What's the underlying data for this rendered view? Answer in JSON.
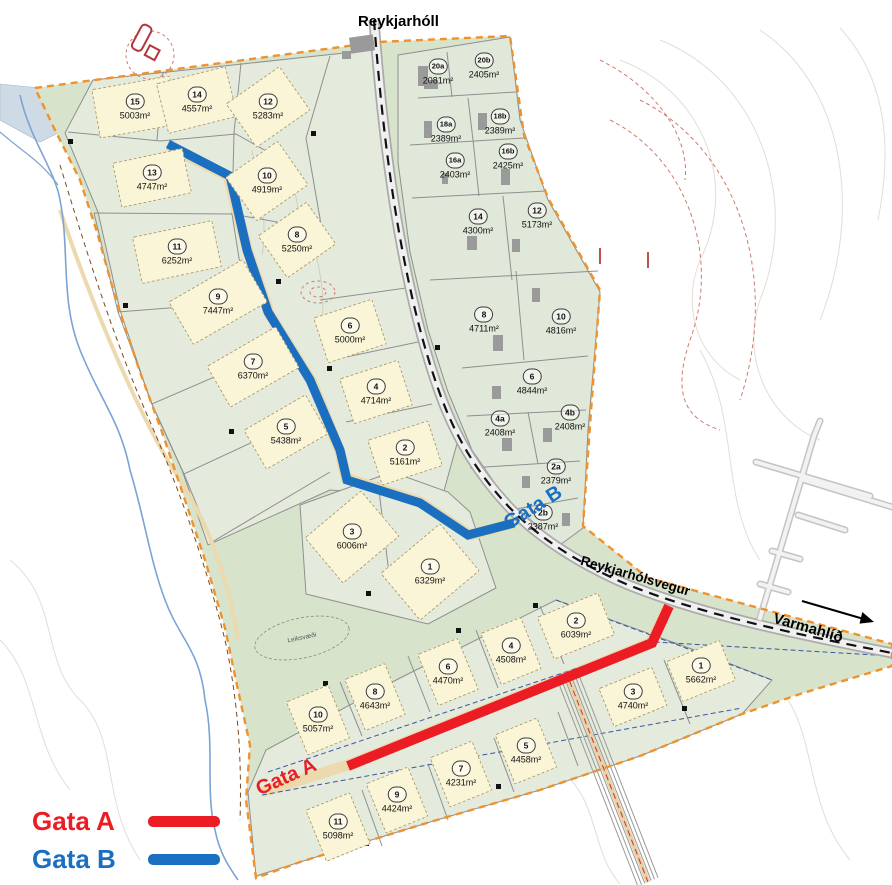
{
  "labels": {
    "reykjarholl": "Reykjarhóll",
    "reykjarholsvegur": "Reykjarhólsvegur",
    "varmahlid": "Varmahlíð",
    "gata_a_road": "Gata A",
    "gata_b_road": "Gata B",
    "leiksvaedi": "Leiksvæði"
  },
  "legend": {
    "items": [
      {
        "label": "Gata A",
        "color": "#ec1c24"
      },
      {
        "label": "Gata B",
        "color": "#1b6fc0"
      }
    ]
  },
  "colors": {
    "gata_a": "#ec1c24",
    "gata_b": "#1b6fc0",
    "boundary_orange": "#f0922c",
    "site_green": "#d8e3cc",
    "lot_green": "#e4ebdd",
    "envelope_yellow": "#fbf5d8"
  },
  "zones": [
    {
      "id": "northwest",
      "lots": [
        {
          "no": "15",
          "area": "5003m²",
          "x": 135,
          "y": 107,
          "env": {
            "w": 78,
            "h": 48,
            "rot": -10
          }
        },
        {
          "no": "14",
          "area": "4557m²",
          "x": 197,
          "y": 100,
          "env": {
            "w": 70,
            "h": 50,
            "rot": -14
          }
        },
        {
          "no": "12",
          "area": "5283m²",
          "x": 268,
          "y": 107,
          "env": {
            "w": 64,
            "h": 52,
            "rot": -35
          }
        },
        {
          "no": "13",
          "area": "4747m²",
          "x": 152,
          "y": 178,
          "env": {
            "w": 70,
            "h": 44,
            "rot": -12
          }
        },
        {
          "no": "10",
          "area": "4919m²",
          "x": 267,
          "y": 181,
          "env": {
            "w": 62,
            "h": 52,
            "rot": -35
          }
        },
        {
          "no": "8",
          "area": "5250m²",
          "x": 297,
          "y": 240,
          "env": {
            "w": 58,
            "h": 50,
            "rot": -35
          }
        },
        {
          "no": "11",
          "area": "6252m²",
          "x": 177,
          "y": 252,
          "env": {
            "w": 80,
            "h": 46,
            "rot": -12
          }
        },
        {
          "no": "9",
          "area": "7447m²",
          "x": 218,
          "y": 302,
          "env": {
            "w": 84,
            "h": 48,
            "rot": -30
          }
        },
        {
          "no": "7",
          "area": "6370m²",
          "x": 253,
          "y": 367,
          "env": {
            "w": 78,
            "h": 46,
            "rot": -30
          }
        },
        {
          "no": "5",
          "area": "5438m²",
          "x": 286,
          "y": 432,
          "env": {
            "w": 70,
            "h": 44,
            "rot": -30
          }
        },
        {
          "no": "6",
          "area": "5000m²",
          "x": 350,
          "y": 331,
          "env": {
            "w": 60,
            "h": 46,
            "rot": -18
          }
        },
        {
          "no": "4",
          "area": "4714m²",
          "x": 376,
          "y": 392,
          "env": {
            "w": 60,
            "h": 46,
            "rot": -18
          }
        },
        {
          "no": "2",
          "area": "5161m²",
          "x": 405,
          "y": 453,
          "env": {
            "w": 62,
            "h": 46,
            "rot": -18
          }
        },
        {
          "no": "3",
          "area": "6006m²",
          "x": 352,
          "y": 537,
          "env": {
            "w": 72,
            "h": 58,
            "rot": -40
          }
        },
        {
          "no": "1",
          "area": "6329m²",
          "x": 430,
          "y": 572,
          "env": {
            "w": 76,
            "h": 60,
            "rot": -40
          }
        }
      ]
    },
    {
      "id": "northeast",
      "lots": [
        {
          "no": "20a",
          "area": "2081m²",
          "x": 438,
          "y": 72
        },
        {
          "no": "20b",
          "area": "2405m²",
          "x": 484,
          "y": 66
        },
        {
          "no": "18a",
          "area": "2389m²",
          "x": 446,
          "y": 130
        },
        {
          "no": "18b",
          "area": "2389m²",
          "x": 500,
          "y": 122
        },
        {
          "no": "16a",
          "area": "2403m²",
          "x": 455,
          "y": 166
        },
        {
          "no": "16b",
          "area": "2425m²",
          "x": 508,
          "y": 157
        },
        {
          "no": "14",
          "area": "4300m²",
          "x": 478,
          "y": 222
        },
        {
          "no": "12",
          "area": "5173m²",
          "x": 537,
          "y": 216
        },
        {
          "no": "8",
          "area": "4711m²",
          "x": 484,
          "y": 320
        },
        {
          "no": "10",
          "area": "4816m²",
          "x": 561,
          "y": 322
        },
        {
          "no": "6",
          "area": "4844m²",
          "x": 532,
          "y": 382
        },
        {
          "no": "4a",
          "area": "2408m²",
          "x": 500,
          "y": 424
        },
        {
          "no": "4b",
          "area": "2408m²",
          "x": 570,
          "y": 418
        },
        {
          "no": "2a",
          "area": "2379m²",
          "x": 556,
          "y": 472
        },
        {
          "no": "2b",
          "area": "2387m²",
          "x": 543,
          "y": 518
        }
      ]
    },
    {
      "id": "south",
      "lots": [
        {
          "no": "2",
          "area": "6039m²",
          "x": 576,
          "y": 626,
          "env": {
            "w": 64,
            "h": 44,
            "rot": -22
          }
        },
        {
          "no": "4",
          "area": "4508m²",
          "x": 511,
          "y": 651,
          "env": {
            "w": 42,
            "h": 54,
            "rot": -22
          }
        },
        {
          "no": "6",
          "area": "4470m²",
          "x": 448,
          "y": 672,
          "env": {
            "w": 42,
            "h": 54,
            "rot": -22
          }
        },
        {
          "no": "8",
          "area": "4643m²",
          "x": 375,
          "y": 697,
          "env": {
            "w": 42,
            "h": 54,
            "rot": -22
          }
        },
        {
          "no": "10",
          "area": "5057m²",
          "x": 318,
          "y": 720,
          "env": {
            "w": 44,
            "h": 56,
            "rot": -22
          }
        },
        {
          "no": "1",
          "area": "5662m²",
          "x": 701,
          "y": 671,
          "env": {
            "w": 56,
            "h": 42,
            "rot": -22
          }
        },
        {
          "no": "3",
          "area": "4740m²",
          "x": 633,
          "y": 697,
          "env": {
            "w": 56,
            "h": 40,
            "rot": -22
          }
        },
        {
          "no": "5",
          "area": "4458m²",
          "x": 526,
          "y": 751,
          "env": {
            "w": 44,
            "h": 52,
            "rot": -22
          }
        },
        {
          "no": "7",
          "area": "4231m²",
          "x": 461,
          "y": 774,
          "env": {
            "w": 44,
            "h": 52,
            "rot": -22
          }
        },
        {
          "no": "9",
          "area": "4424m²",
          "x": 397,
          "y": 800,
          "env": {
            "w": 44,
            "h": 52,
            "rot": -22
          }
        },
        {
          "no": "11",
          "area": "5098m²",
          "x": 338,
          "y": 827,
          "env": {
            "w": 46,
            "h": 54,
            "rot": -22
          }
        }
      ]
    }
  ]
}
